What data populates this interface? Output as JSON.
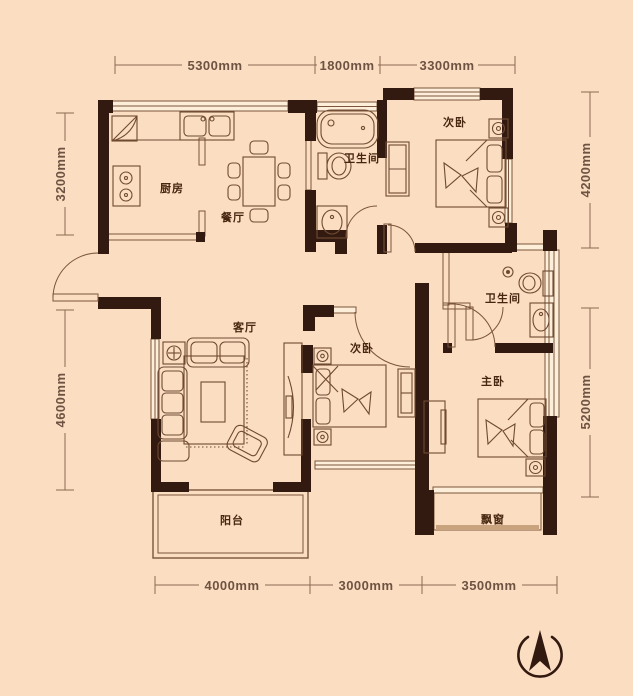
{
  "title": "apartment-floor-plan",
  "colors": {
    "background": "#fbddc2",
    "wall": "#331a10",
    "line": "#7a553c",
    "dimension_text": "#6f5342",
    "room_text": "#46260f"
  },
  "dimensions": {
    "top": [
      "5300mm",
      "1800mm",
      "3300mm"
    ],
    "bottom": [
      "4000mm",
      "3000mm",
      "3500mm"
    ],
    "left": [
      "3200mm",
      "4600mm"
    ],
    "right": [
      "4200mm",
      "5200mm"
    ]
  },
  "rooms": {
    "kitchen": "厨房",
    "dining": "餐厅",
    "bathroom1": "卫生间",
    "bedroom_top": "次卧",
    "living": "客厅",
    "bedroom_mid": "次卧",
    "bathroom2": "卫生间",
    "master": "主卧",
    "balcony": "阳台",
    "bay_window": "飘窗"
  },
  "icons": {
    "compass": "north-arrow"
  }
}
